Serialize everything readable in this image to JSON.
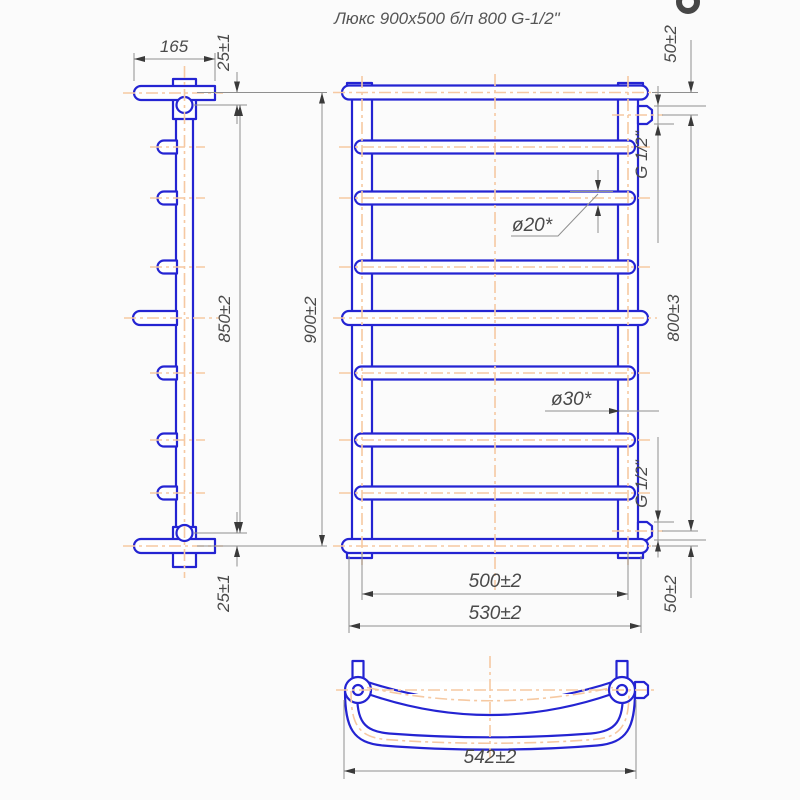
{
  "title": "Люкс 900x500 б/п 800 G-1/2\"",
  "colors": {
    "outline_blue": "#2424d2",
    "centerline_orange": "#f6c9a2",
    "dimension_gray": "#8f8f8f",
    "text_gray": "#4a4a4a"
  },
  "side_view": {
    "dim_bar_length": "165",
    "dim_offset_top": "25±1",
    "dim_tube_length": "850±2",
    "dim_offset_bottom": "25±1"
  },
  "front_view": {
    "dim_height": "900±2",
    "dim_rung_diameter": "ø20*",
    "dim_tube_diameter": "ø30*",
    "dim_rung_span": "500±2",
    "dim_overall_width": "530±2",
    "dim_top_connection_offset": "50±2",
    "dim_connection_spacing": "800±3",
    "dim_bottom_connection_offset": "50±2",
    "thread_top": "G 1/2\"",
    "thread_bottom": "G 1/2\""
  },
  "top_view": {
    "dim_overall_width": "542±2"
  }
}
